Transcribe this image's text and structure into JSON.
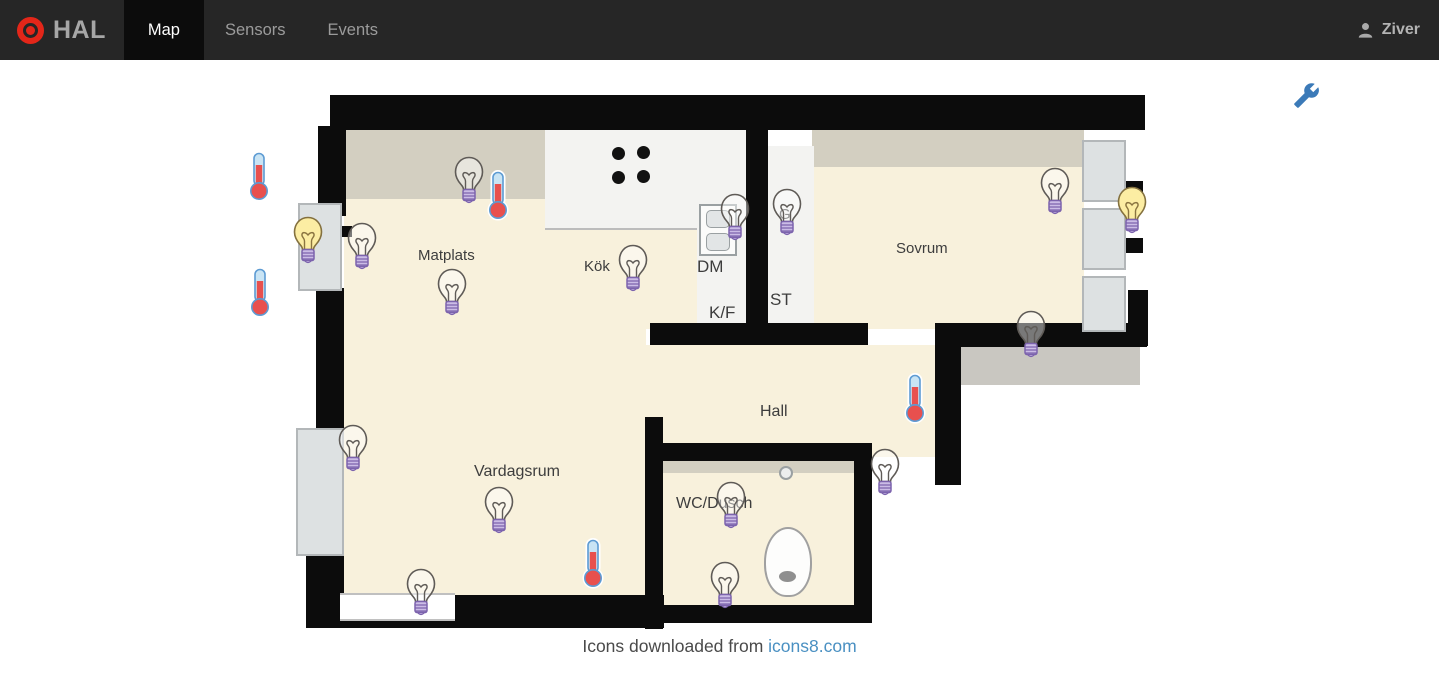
{
  "nav": {
    "brand": "HAL",
    "tabs": [
      {
        "label": "Map",
        "active": true
      },
      {
        "label": "Sensors",
        "active": false
      },
      {
        "label": "Events",
        "active": false
      }
    ],
    "user": "Ziver"
  },
  "colors": {
    "nav_bg": "#262626",
    "active_tab_bg": "#0c0c0c",
    "brand_red": "#e32619",
    "nav_text_gray": "#9b9b9b",
    "floor_beige": "#f8f1dc",
    "wall_black": "#0c0c0c",
    "bulb_on_yellow": "#fceda3",
    "bulb_base_purple": "#cbbce6",
    "thermometer_red": "#e8504e",
    "thermometer_tube_blue": "#c9e4f4",
    "wrench_blue": "#3b7ab8",
    "link_blue": "#4a90c2"
  },
  "icons": {
    "brand": "target-icon",
    "user": "person-icon",
    "map_settings": "wrench-icon",
    "light_sensor": "light-bulb-icon",
    "temperature_sensor": "thermometer-icon"
  },
  "map": {
    "room_labels": [
      {
        "text": "Matplats",
        "x": 418,
        "y": 247,
        "size": 15
      },
      {
        "text": "Kök",
        "x": 584,
        "y": 258,
        "size": 15
      },
      {
        "text": "DM",
        "x": 697,
        "y": 257,
        "size": 17
      },
      {
        "text": "K/F",
        "x": 709,
        "y": 303,
        "size": 17
      },
      {
        "text": "ST",
        "x": 770,
        "y": 290,
        "size": 17
      },
      {
        "text": "G",
        "x": 779,
        "y": 206,
        "size": 15
      },
      {
        "text": "Sovrum",
        "x": 896,
        "y": 240,
        "size": 15
      },
      {
        "text": "Hall",
        "x": 760,
        "y": 403,
        "size": 16
      },
      {
        "text": "Vardagsrum",
        "x": 474,
        "y": 463,
        "size": 16
      },
      {
        "text": "WC/Dusch",
        "x": 676,
        "y": 495,
        "size": 16
      }
    ],
    "sensors": [
      {
        "type": "light",
        "state": "off",
        "x": 452,
        "y": 155
      },
      {
        "type": "light",
        "state": "on",
        "x": 291,
        "y": 215
      },
      {
        "type": "light",
        "state": "off",
        "x": 345,
        "y": 221
      },
      {
        "type": "light",
        "state": "off",
        "x": 435,
        "y": 267
      },
      {
        "type": "light",
        "state": "off",
        "x": 616,
        "y": 243
      },
      {
        "type": "light",
        "state": "off",
        "x": 718,
        "y": 192
      },
      {
        "type": "light",
        "state": "off",
        "x": 770,
        "y": 187
      },
      {
        "type": "light",
        "state": "off",
        "x": 1038,
        "y": 166
      },
      {
        "type": "light",
        "state": "on",
        "x": 1115,
        "y": 185
      },
      {
        "type": "light",
        "state": "off",
        "x": 1014,
        "y": 309
      },
      {
        "type": "light",
        "state": "off",
        "x": 868,
        "y": 447
      },
      {
        "type": "light",
        "state": "off",
        "x": 336,
        "y": 423
      },
      {
        "type": "light",
        "state": "off",
        "x": 482,
        "y": 485
      },
      {
        "type": "light",
        "state": "off",
        "x": 404,
        "y": 567
      },
      {
        "type": "light",
        "state": "off",
        "x": 714,
        "y": 480
      },
      {
        "type": "light",
        "state": "off",
        "x": 708,
        "y": 560
      },
      {
        "type": "temperature",
        "x": 246,
        "y": 150
      },
      {
        "type": "temperature",
        "x": 247,
        "y": 266
      },
      {
        "type": "temperature",
        "x": 485,
        "y": 169
      },
      {
        "type": "temperature",
        "x": 902,
        "y": 372
      },
      {
        "type": "temperature",
        "x": 580,
        "y": 537
      }
    ],
    "caption": {
      "text": "Icons downloaded from ",
      "link": "icons8.com"
    }
  }
}
